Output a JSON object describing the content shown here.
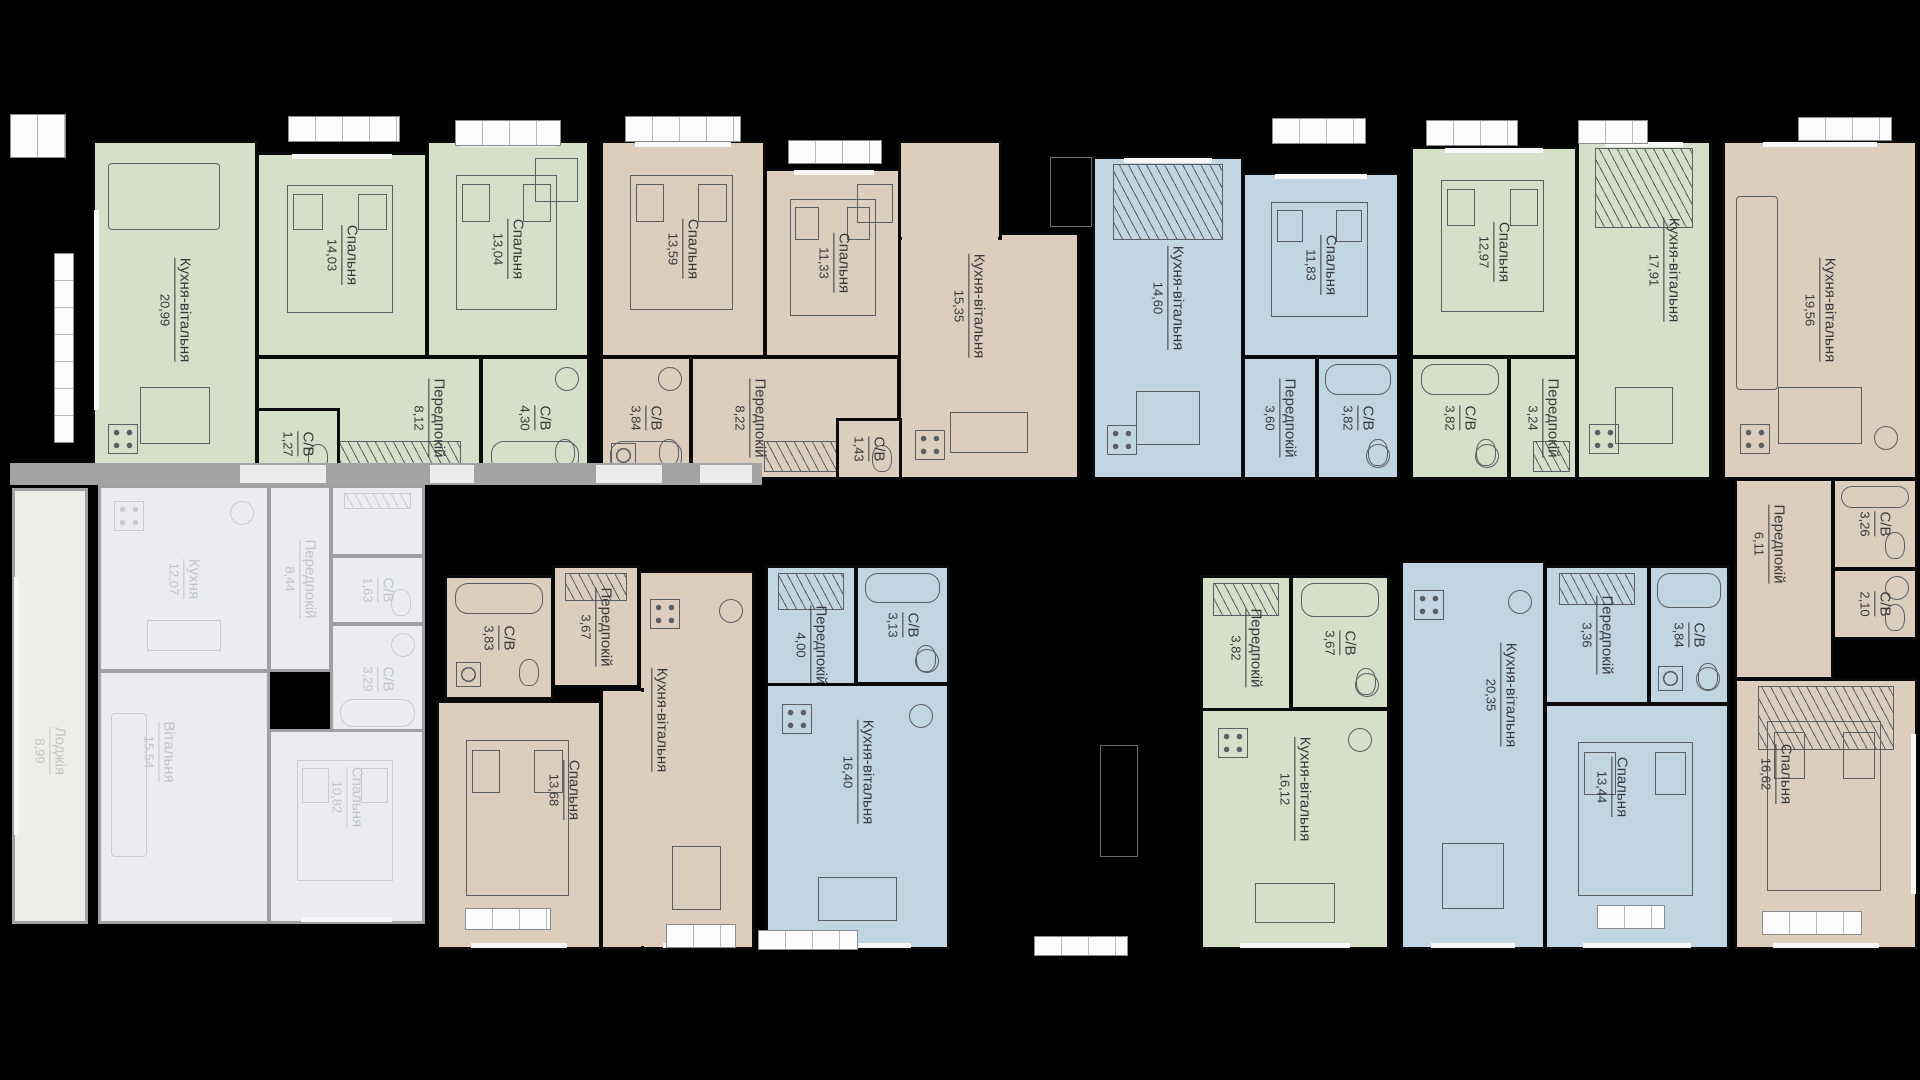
{
  "plan": {
    "canvas": {
      "w": 1920,
      "h": 1080,
      "bg": "#000000"
    },
    "palette": {
      "green": "#d6dfc8",
      "tan": "#ddcdbd",
      "blue": "#c1d6e2",
      "mutedFill": "#eaecef",
      "mutedLoggia": "#eeede7",
      "wall": "#0a0a0a",
      "mutedWall": "#9ea0a4",
      "label": "#36383b",
      "mutedLabel": "#c2c4c8",
      "furniture": "#5b5e63",
      "mutedFurniture": "#c9cbd0",
      "railFill": "#fbfbfb",
      "walk": "#a3a3a3",
      "ghost": "#6a6c6e"
    },
    "apartments": [
      {
        "name": "apartment-top-1",
        "color": "green",
        "muted": false,
        "rooms": [
          {
            "key": "kitchen-living",
            "label": "Кухня-вітальня",
            "area": "20,99",
            "x": 92,
            "y": 140,
            "w": 166,
            "h": 340,
            "fx": [
              "sofa",
              "table",
              "stoveB"
            ],
            "win": "l"
          },
          {
            "key": "bedroom-1",
            "label": "Спальня",
            "area": "14,03",
            "x": 256,
            "y": 152,
            "w": 172,
            "h": 206,
            "fx": [
              "bed"
            ],
            "win": "t"
          },
          {
            "key": "bedroom-2",
            "label": "Спальня",
            "area": "13,04",
            "x": 426,
            "y": 140,
            "w": 164,
            "h": 218,
            "fx": [
              "bed",
              "desk"
            ],
            "win": "t"
          },
          {
            "key": "hallway",
            "label": "Передпокій",
            "area": "8,12",
            "x": 256,
            "y": 356,
            "w": 226,
            "h": 124,
            "fx": [
              "wardrobeB"
            ],
            "dx": 60
          },
          {
            "key": "bathroom-1",
            "label": "С/В",
            "area": "1,27",
            "x": 256,
            "y": 408,
            "w": 84,
            "h": 72,
            "fx": [
              "wc"
            ]
          },
          {
            "key": "bathroom-2",
            "label": "С/В",
            "area": "4,30",
            "x": 480,
            "y": 356,
            "w": 110,
            "h": 124,
            "fx": [
              "bathB",
              "sink",
              "wc"
            ]
          }
        ]
      },
      {
        "name": "apartment-top-2",
        "color": "tan",
        "muted": false,
        "rooms": [
          {
            "key": "bedroom-1",
            "label": "Спальня",
            "area": "13,59",
            "x": 600,
            "y": 140,
            "w": 166,
            "h": 218,
            "fx": [
              "bed"
            ],
            "win": "t"
          },
          {
            "key": "bedroom-2",
            "label": "Спальня",
            "area": "11,33",
            "x": 764,
            "y": 168,
            "w": 140,
            "h": 190,
            "fx": [
              "bed",
              "desk"
            ],
            "win": "t"
          },
          {
            "key": "kitchen-living",
            "label": "Кухня-вітальня",
            "area": "15,35",
            "x": 898,
            "y": 232,
            "w": 182,
            "h": 248,
            "fx": [
              "table",
              "stoveB"
            ],
            "dx": -20,
            "dy": -50,
            "parts": [
              {
                "x": 898,
                "y": 140,
                "w": 104,
                "h": 100
              }
            ],
            "patches": [
              {
                "x": 902,
                "y": 230,
                "w": 96,
                "h": 14
              }
            ]
          },
          {
            "key": "bathroom-1",
            "label": "С/В",
            "area": "3,84",
            "x": 600,
            "y": 356,
            "w": 92,
            "h": 124,
            "fx": [
              "bathB",
              "sink",
              "wc",
              "washer"
            ]
          },
          {
            "key": "hallway",
            "label": "Передпокій",
            "area": "8,22",
            "x": 690,
            "y": 356,
            "w": 210,
            "h": 124,
            "fx": [
              "wardrobeB"
            ],
            "dx": -45
          },
          {
            "key": "bathroom-2",
            "label": "С/В",
            "area": "1,43",
            "x": 836,
            "y": 418,
            "w": 66,
            "h": 62,
            "fx": [
              "wc"
            ]
          }
        ]
      },
      {
        "name": "apartment-top-3",
        "color": "blue",
        "muted": false,
        "rooms": [
          {
            "key": "kitchen-living",
            "label": "Кухня-вітальня",
            "area": "14,60",
            "x": 1092,
            "y": 156,
            "w": 152,
            "h": 324,
            "fx": [
              "wardrobe",
              "table",
              "stoveB"
            ],
            "win": "t",
            "dy": -20
          },
          {
            "key": "bedroom",
            "label": "Спальня",
            "area": "11,83",
            "x": 1242,
            "y": 172,
            "w": 158,
            "h": 186,
            "fx": [
              "bed"
            ],
            "win": "t"
          },
          {
            "key": "hallway",
            "label": "Передпокій",
            "area": "3,60",
            "x": 1242,
            "y": 356,
            "w": 76,
            "h": 124,
            "fx": []
          },
          {
            "key": "bathroom",
            "label": "С/В",
            "area": "3,82",
            "x": 1316,
            "y": 356,
            "w": 84,
            "h": 124,
            "fx": [
              "bath",
              "sinkB",
              "wc"
            ]
          }
        ]
      },
      {
        "name": "apartment-top-4",
        "color": "green",
        "muted": false,
        "rooms": [
          {
            "key": "bedroom",
            "label": "Спальня",
            "area": "12,97",
            "x": 1410,
            "y": 146,
            "w": 168,
            "h": 212,
            "fx": [
              "bed"
            ],
            "win": "t"
          },
          {
            "key": "kitchen-living",
            "label": "Кухня-вітальня",
            "area": "17,91",
            "x": 1576,
            "y": 140,
            "w": 136,
            "h": 340,
            "fx": [
              "wardrobe",
              "table",
              "stoveB"
            ],
            "win": "t",
            "dx": 20,
            "dy": -40
          },
          {
            "key": "bathroom",
            "label": "С/В",
            "area": "3,82",
            "x": 1410,
            "y": 356,
            "w": 100,
            "h": 124,
            "fx": [
              "bath",
              "sinkB",
              "wc"
            ]
          },
          {
            "key": "hallway",
            "label": "Передпокій",
            "area": "3,24",
            "x": 1508,
            "y": 356,
            "w": 70,
            "h": 124,
            "fx": [
              "wardrobeB"
            ]
          }
        ]
      },
      {
        "name": "apartment-top-5",
        "color": "tan",
        "muted": false,
        "rooms": [
          {
            "key": "kitchen-living",
            "label": "Кухня-вітальня",
            "area": "19,56",
            "x": 1722,
            "y": 140,
            "w": 196,
            "h": 340,
            "fx": [
              "sofaV",
              "table",
              "stoveB",
              "sinkB"
            ],
            "win": "t"
          },
          {
            "key": "hallway",
            "label": "Передпокій",
            "area": "6,11",
            "x": 1734,
            "y": 478,
            "w": 100,
            "h": 202,
            "fx": [],
            "dx": -15,
            "dy": -35
          },
          {
            "key": "bathroom-1",
            "label": "С/В",
            "area": "3,26",
            "x": 1832,
            "y": 478,
            "w": 86,
            "h": 92,
            "fx": [
              "bath",
              "wc"
            ]
          },
          {
            "key": "bathroom-2",
            "label": "С/В",
            "area": "2,10",
            "x": 1832,
            "y": 568,
            "w": 86,
            "h": 72,
            "fx": [
              "sink",
              "wc"
            ]
          },
          {
            "key": "bedroom",
            "label": "Спальня",
            "area": "16,62",
            "x": 1734,
            "y": 678,
            "w": 184,
            "h": 272,
            "fx": [
              "wardrobe",
              "bed"
            ],
            "win": "br",
            "dx": -50,
            "dy": -40
          }
        ]
      },
      {
        "name": "apartment-bottom-1",
        "color": "muted",
        "muted": true,
        "rooms": [
          {
            "key": "loggia",
            "label": "Лоджія",
            "area": "8,99",
            "x": 12,
            "y": 488,
            "w": 76,
            "h": 436,
            "fx": [],
            "win": "l",
            "dy": 45,
            "fillKey": "mutedLoggia"
          },
          {
            "key": "kitchen",
            "label": "Кухня",
            "area": "12,07",
            "x": 98,
            "y": 485,
            "w": 172,
            "h": 187,
            "fx": [
              "stove",
              "sink",
              "table"
            ]
          },
          {
            "key": "hallway",
            "label": "Передпокій",
            "area": "8,44",
            "x": 268,
            "y": 485,
            "w": 64,
            "h": 187,
            "fx": []
          },
          {
            "key": "wardrobe-nook",
            "label": "",
            "area": "",
            "x": 330,
            "y": 485,
            "w": 95,
            "h": 72,
            "fx": [
              "wardrobe"
            ]
          },
          {
            "key": "bathroom-1",
            "label": "С/В",
            "area": "1,63",
            "x": 330,
            "y": 555,
            "w": 95,
            "h": 70,
            "fx": [
              "wc"
            ]
          },
          {
            "key": "bathroom-2",
            "label": "С/В",
            "area": "3,29",
            "x": 330,
            "y": 623,
            "w": 95,
            "h": 112,
            "fx": [
              "bathB",
              "sink"
            ]
          },
          {
            "key": "living-room",
            "label": "Вітальня",
            "area": "15,54",
            "x": 98,
            "y": 670,
            "w": 172,
            "h": 254,
            "fx": [
              "sofaV"
            ],
            "dx": -25,
            "dy": -45
          },
          {
            "key": "bedroom",
            "label": "Спальня",
            "area": "10,82",
            "x": 268,
            "y": 729,
            "w": 157,
            "h": 195,
            "fx": [
              "bed"
            ],
            "dy": -30,
            "win": "b"
          }
        ]
      },
      {
        "name": "apartment-bottom-2",
        "color": "tan",
        "muted": false,
        "rooms": [
          {
            "key": "bathroom",
            "label": "С/В",
            "area": "3,83",
            "x": 444,
            "y": 575,
            "w": 110,
            "h": 125,
            "fx": [
              "bath",
              "wc",
              "washer"
            ]
          },
          {
            "key": "hallway",
            "label": "Передпокій",
            "area": "3,67",
            "x": 552,
            "y": 565,
            "w": 88,
            "h": 123,
            "fx": [
              "wardrobe"
            ]
          },
          {
            "key": "bedroom",
            "label": "Спальня",
            "area": "13,68",
            "x": 436,
            "y": 700,
            "w": 166,
            "h": 250,
            "fx": [
              "bed"
            ],
            "win": "b",
            "dx": 45,
            "dy": -35
          },
          {
            "key": "kitchen-living",
            "label": "Кухня-вітальня",
            "area": "19,78",
            "x": 638,
            "y": 570,
            "w": 117,
            "h": 380,
            "fx": [
              "stove",
              "sink",
              "table"
            ],
            "win": "b",
            "dx": -45,
            "dy": -40,
            "parts": [
              {
                "x": 600,
                "y": 688,
                "w": 44,
                "h": 262
              }
            ],
            "patches": [
              {
                "x": 633,
                "y": 692,
                "w": 14,
                "h": 254
              }
            ]
          }
        ]
      },
      {
        "name": "apartment-bottom-3",
        "color": "blue",
        "muted": false,
        "rooms": [
          {
            "key": "hallway",
            "label": "Передпокій",
            "area": "4,00",
            "x": 765,
            "y": 565,
            "w": 92,
            "h": 160,
            "fx": [
              "wardrobe"
            ]
          },
          {
            "key": "bathroom",
            "label": "С/В",
            "area": "3,13",
            "x": 855,
            "y": 565,
            "w": 95,
            "h": 120,
            "fx": [
              "bath",
              "sinkB",
              "wc"
            ]
          },
          {
            "key": "kitchen-living",
            "label": "Кухня-вітальня",
            "area": "16,40",
            "x": 765,
            "y": 683,
            "w": 185,
            "h": 267,
            "fx": [
              "stove",
              "sink",
              "table"
            ],
            "win": "b",
            "dy": -45
          }
        ]
      },
      {
        "name": "apartment-bottom-4",
        "color": "green",
        "muted": false,
        "rooms": [
          {
            "key": "hallway",
            "label": "Передпокій",
            "area": "3,82",
            "x": 1200,
            "y": 575,
            "w": 92,
            "h": 145,
            "fx": [
              "wardrobe"
            ]
          },
          {
            "key": "bathroom",
            "label": "С/В",
            "area": "3,67",
            "x": 1290,
            "y": 575,
            "w": 100,
            "h": 135,
            "fx": [
              "bath",
              "sinkB",
              "wc"
            ]
          },
          {
            "key": "kitchen-living",
            "label": "Кухня-вітальня",
            "area": "16,12",
            "x": 1200,
            "y": 708,
            "w": 190,
            "h": 242,
            "fx": [
              "stove",
              "sink",
              "table"
            ],
            "win": "b",
            "dy": -40
          }
        ]
      },
      {
        "name": "apartment-bottom-5",
        "color": "blue",
        "muted": false,
        "rooms": [
          {
            "key": "kitchen-living",
            "label": "Кухня-вітальня",
            "area": "20,35",
            "x": 1400,
            "y": 560,
            "w": 146,
            "h": 390,
            "fx": [
              "stove",
              "sink",
              "table"
            ],
            "win": "b",
            "dx": 28,
            "dy": -60
          },
          {
            "key": "hallway",
            "label": "Передпокій",
            "area": "3,36",
            "x": 1544,
            "y": 565,
            "w": 106,
            "h": 140,
            "fx": [
              "wardrobe"
            ]
          },
          {
            "key": "bathroom",
            "label": "С/В",
            "area": "3,84",
            "x": 1648,
            "y": 565,
            "w": 82,
            "h": 140,
            "fx": [
              "bath",
              "sinkB",
              "wc",
              "washer"
            ]
          },
          {
            "key": "bedroom",
            "label": "Спальня",
            "area": "13,44",
            "x": 1544,
            "y": 703,
            "w": 186,
            "h": 247,
            "fx": [
              "bed"
            ],
            "win": "b",
            "dx": -25,
            "dy": -40
          }
        ]
      }
    ],
    "railings": [
      {
        "x": 10,
        "y": 114,
        "w": 56,
        "h": 44
      },
      {
        "x": 288,
        "y": 116,
        "w": 112,
        "h": 26
      },
      {
        "x": 455,
        "y": 120,
        "w": 106,
        "h": 26
      },
      {
        "x": 625,
        "y": 116,
        "w": 116,
        "h": 26
      },
      {
        "x": 788,
        "y": 140,
        "w": 94,
        "h": 24
      },
      {
        "x": 1272,
        "y": 118,
        "w": 94,
        "h": 26
      },
      {
        "x": 1426,
        "y": 120,
        "w": 92,
        "h": 26
      },
      {
        "x": 1578,
        "y": 120,
        "w": 70,
        "h": 24
      },
      {
        "x": 1798,
        "y": 117,
        "w": 94,
        "h": 24
      },
      {
        "x": 54,
        "y": 253,
        "w": 20,
        "h": 190,
        "v": true
      },
      {
        "x": 465,
        "y": 908,
        "w": 86,
        "h": 22
      },
      {
        "x": 666,
        "y": 924,
        "w": 70,
        "h": 24
      },
      {
        "x": 758,
        "y": 930,
        "w": 100,
        "h": 20
      },
      {
        "x": 1034,
        "y": 936,
        "w": 94,
        "h": 20
      },
      {
        "x": 1597,
        "y": 905,
        "w": 68,
        "h": 24
      },
      {
        "x": 1762,
        "y": 911,
        "w": 100,
        "h": 24
      }
    ],
    "walks": [
      {
        "x": 10,
        "y": 463,
        "w": 752,
        "h": 22
      }
    ],
    "walkTicks": [
      {
        "x": 240,
        "y": 465,
        "w": 86,
        "h": 18
      },
      {
        "x": 430,
        "y": 465,
        "w": 44,
        "h": 18
      },
      {
        "x": 596,
        "y": 465,
        "w": 66,
        "h": 18
      },
      {
        "x": 700,
        "y": 465,
        "w": 52,
        "h": 18
      }
    ],
    "ghosts": [
      {
        "x": 1050,
        "y": 157,
        "w": 42,
        "h": 70
      },
      {
        "x": 1096,
        "y": 157,
        "w": 44,
        "h": 70
      },
      {
        "x": 1100,
        "y": 745,
        "w": 38,
        "h": 112
      }
    ]
  }
}
